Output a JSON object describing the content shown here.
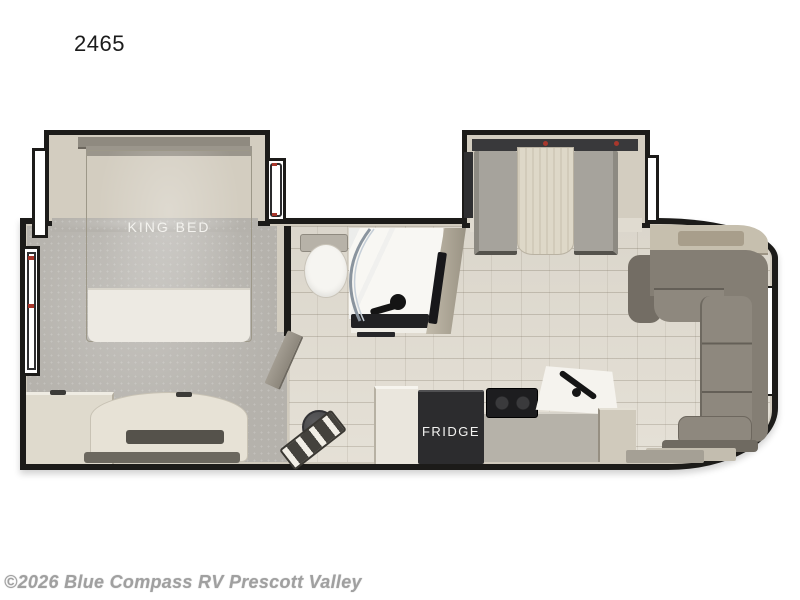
{
  "page": {
    "model_number": "2465",
    "watermark": "©2026 Blue Compass RV Prescott Valley"
  },
  "floorplan": {
    "room_labels": {
      "king_bed": "KING BED",
      "fridge": "FRIDGE"
    },
    "features": [
      "king-bed-slideout",
      "front-dresser",
      "foot-of-bed-bench",
      "bathroom-toilet",
      "shower-with-curved-glass-door",
      "vanity",
      "tv",
      "bathroom-door",
      "entry-steps",
      "pedestal-table",
      "refrigerator",
      "stove",
      "kitchen-sink",
      "kitchen-counter",
      "dinette-slideout-with-table",
      "rear-l-shaped-sectional-sofa",
      "rear-counter",
      "windows"
    ],
    "colors": {
      "wall": "#1c1b19",
      "wall_lining": "#d0cabd",
      "carpet": "#b5b2ac",
      "tile_floor": "#e2ddd2",
      "sofa": "#857f75",
      "dinette_table": "#ded8c8",
      "fridge_box": "#2c2c2e",
      "accent_red": "#b03a2e",
      "label_text": "#f3f2ee",
      "watermark_text": "#a0a0a0"
    }
  }
}
